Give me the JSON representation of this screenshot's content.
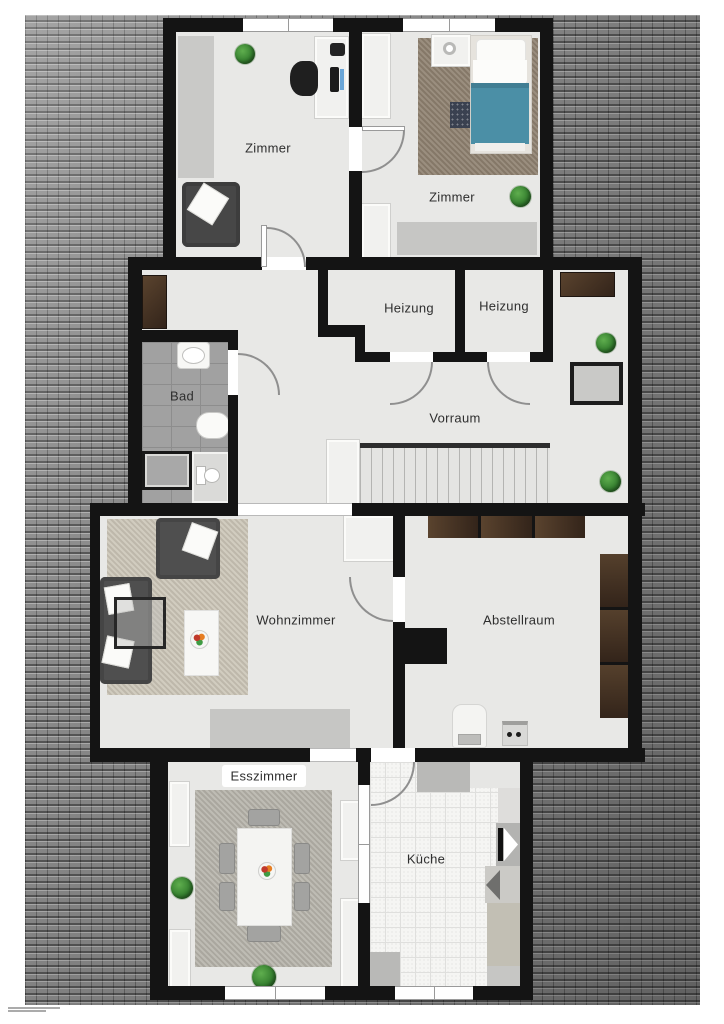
{
  "floorplan": {
    "rooms": {
      "zimmer_top_left": {
        "label": "Zimmer"
      },
      "zimmer_top_right": {
        "label": "Zimmer"
      },
      "heizung_left": {
        "label": "Heizung"
      },
      "heizung_right": {
        "label": "Heizung"
      },
      "bad": {
        "label": "Bad"
      },
      "vorraum": {
        "label": "Vorraum"
      },
      "wohnzimmer": {
        "label": "Wohnzimmer"
      },
      "abstellraum": {
        "label": "Abstellraum"
      },
      "esszimmer": {
        "label": "Esszimmer"
      },
      "kueche": {
        "label": "Küche"
      }
    },
    "palette": {
      "wall": "#141414",
      "floor": "#e8e8e6",
      "roof_tile": "#8b8b8b",
      "bath_tile": "#a1a1a1",
      "bed_blanket": "#4b8fa6",
      "carpet_living": "#ccc6b8",
      "carpet_dining": "#b7b4ab",
      "carpet_bedroom": "#8f8170",
      "furniture_brown": "#4a3626",
      "sofa_gray": "#4f4f4f",
      "plant_green": "#368030"
    },
    "icons": [
      "plant-icon",
      "bed-icon",
      "nightstand-icon",
      "desk-icon",
      "office-chair-icon",
      "armchair-icon",
      "wardrobe-icon",
      "bench-icon",
      "sink-icon",
      "bathtub-icon",
      "shower-icon",
      "toilet-icon",
      "stairs-icon",
      "sofa-icon",
      "coffee-table-icon",
      "fruit-bowl-icon",
      "sideboard-icon",
      "shelf-icon",
      "boiler-icon",
      "washer-icon",
      "dining-table-icon",
      "chair-icon",
      "kitchen-counter-icon",
      "door-arc-icon",
      "window-icon"
    ]
  }
}
